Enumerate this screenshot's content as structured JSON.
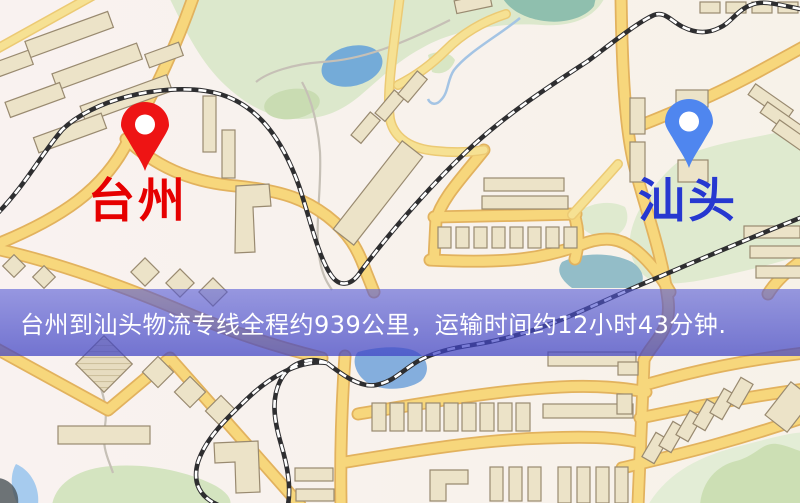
{
  "map": {
    "markers": {
      "origin": {
        "label": "台州",
        "label_color": "#e60000",
        "pin_color": "#ee1414"
      },
      "destination": {
        "label": "汕头",
        "label_color": "#2638d0",
        "pin_color": "#4f86ef"
      }
    },
    "banner": {
      "text": "台州到汕头物流专线全程约939公里，运输时间约12小时43分钟.",
      "background_color": "rgba(73,78,204,0.66)",
      "text_color": "#ffffff"
    },
    "palette": {
      "road_fill": "#f7d77c",
      "road_casing": "#e2b25e",
      "park_green": "#dce8cc",
      "water_blue": "#74abd8",
      "building_beige": "#ece3c8",
      "background": "#f7f1ec"
    }
  }
}
